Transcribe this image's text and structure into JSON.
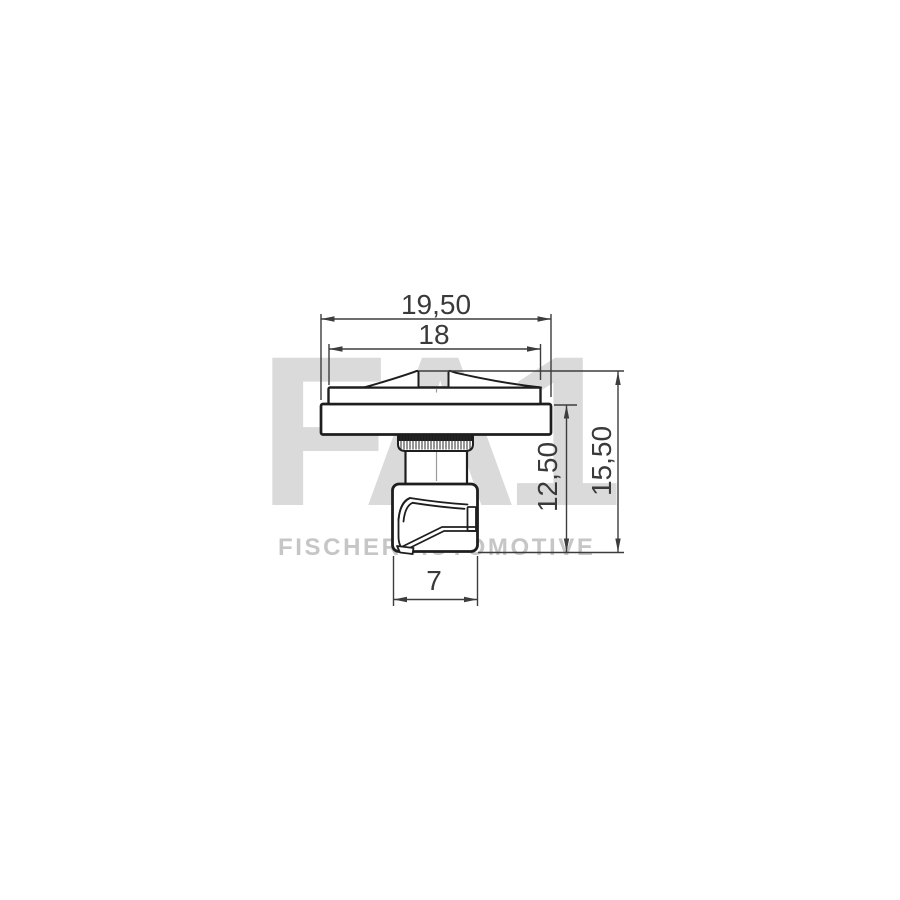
{
  "drawing": {
    "type": "technical-part-drawing",
    "part": "fastener-clip-side-view",
    "dimensions": {
      "outer_width": "19,50",
      "cap_width": "18",
      "body_height": "12,50",
      "total_height": "15,50",
      "foot_width": "7"
    }
  },
  "watermark": {
    "logo": "FA1",
    "brand_text": "FISCHER AUTOMOTIVE"
  },
  "colors": {
    "background": "#ffffff",
    "part_outline": "#1e1e1e",
    "dimension_lines": "#3d3d3d",
    "dimension_text": "#3a3a3a",
    "watermark_logo": "#dadada",
    "watermark_text": "#c6c6c6"
  }
}
